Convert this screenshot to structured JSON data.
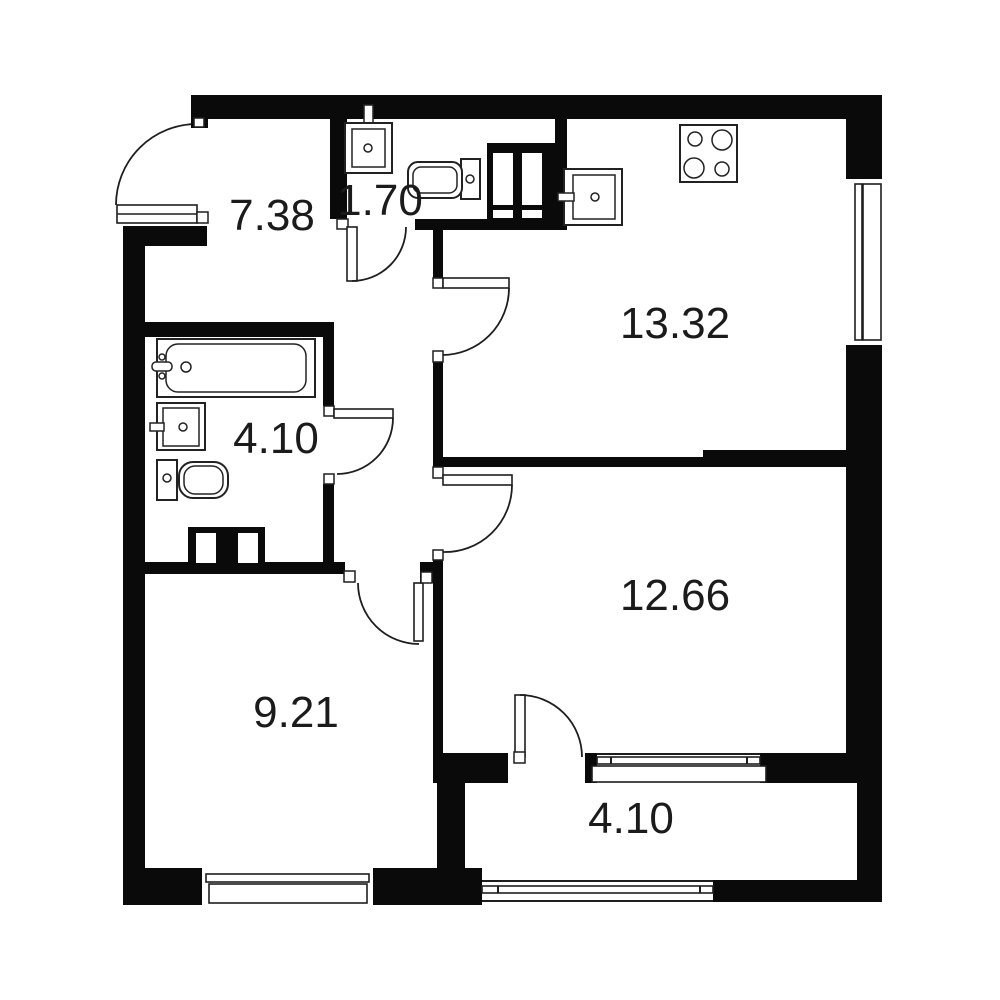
{
  "colors": {
    "background": "#ffffff",
    "wall": "#0a0a0a",
    "line": "#1e1e1e",
    "label_text": "#1b1b1b"
  },
  "plan_type": "apartment-floor-plan",
  "rooms": {
    "hallway": {
      "area": "7.38"
    },
    "wc": {
      "area": "1.70"
    },
    "kitchen": {
      "area": "13.32"
    },
    "bathroom": {
      "area": "4.10"
    },
    "living_room": {
      "area": "12.66"
    },
    "bedroom": {
      "area": "9.21"
    },
    "balcony": {
      "area": "4.10"
    }
  },
  "icons": {
    "fixtures": [
      "wc-sink-icon",
      "washing-machine-icon",
      "ventilation-shaft-icon",
      "kitchen-sink-icon",
      "stove-icon",
      "bathtub-icon",
      "bathroom-sink-icon",
      "toilet-icon",
      "duct-icon"
    ],
    "openings": [
      "entry-door",
      "wc-door",
      "kitchen-door",
      "bathroom-door",
      "living-room-door",
      "bedroom-door",
      "balcony-door",
      "kitchen-window",
      "bedroom-window",
      "balcony-inner-window",
      "balcony-glazing"
    ]
  }
}
